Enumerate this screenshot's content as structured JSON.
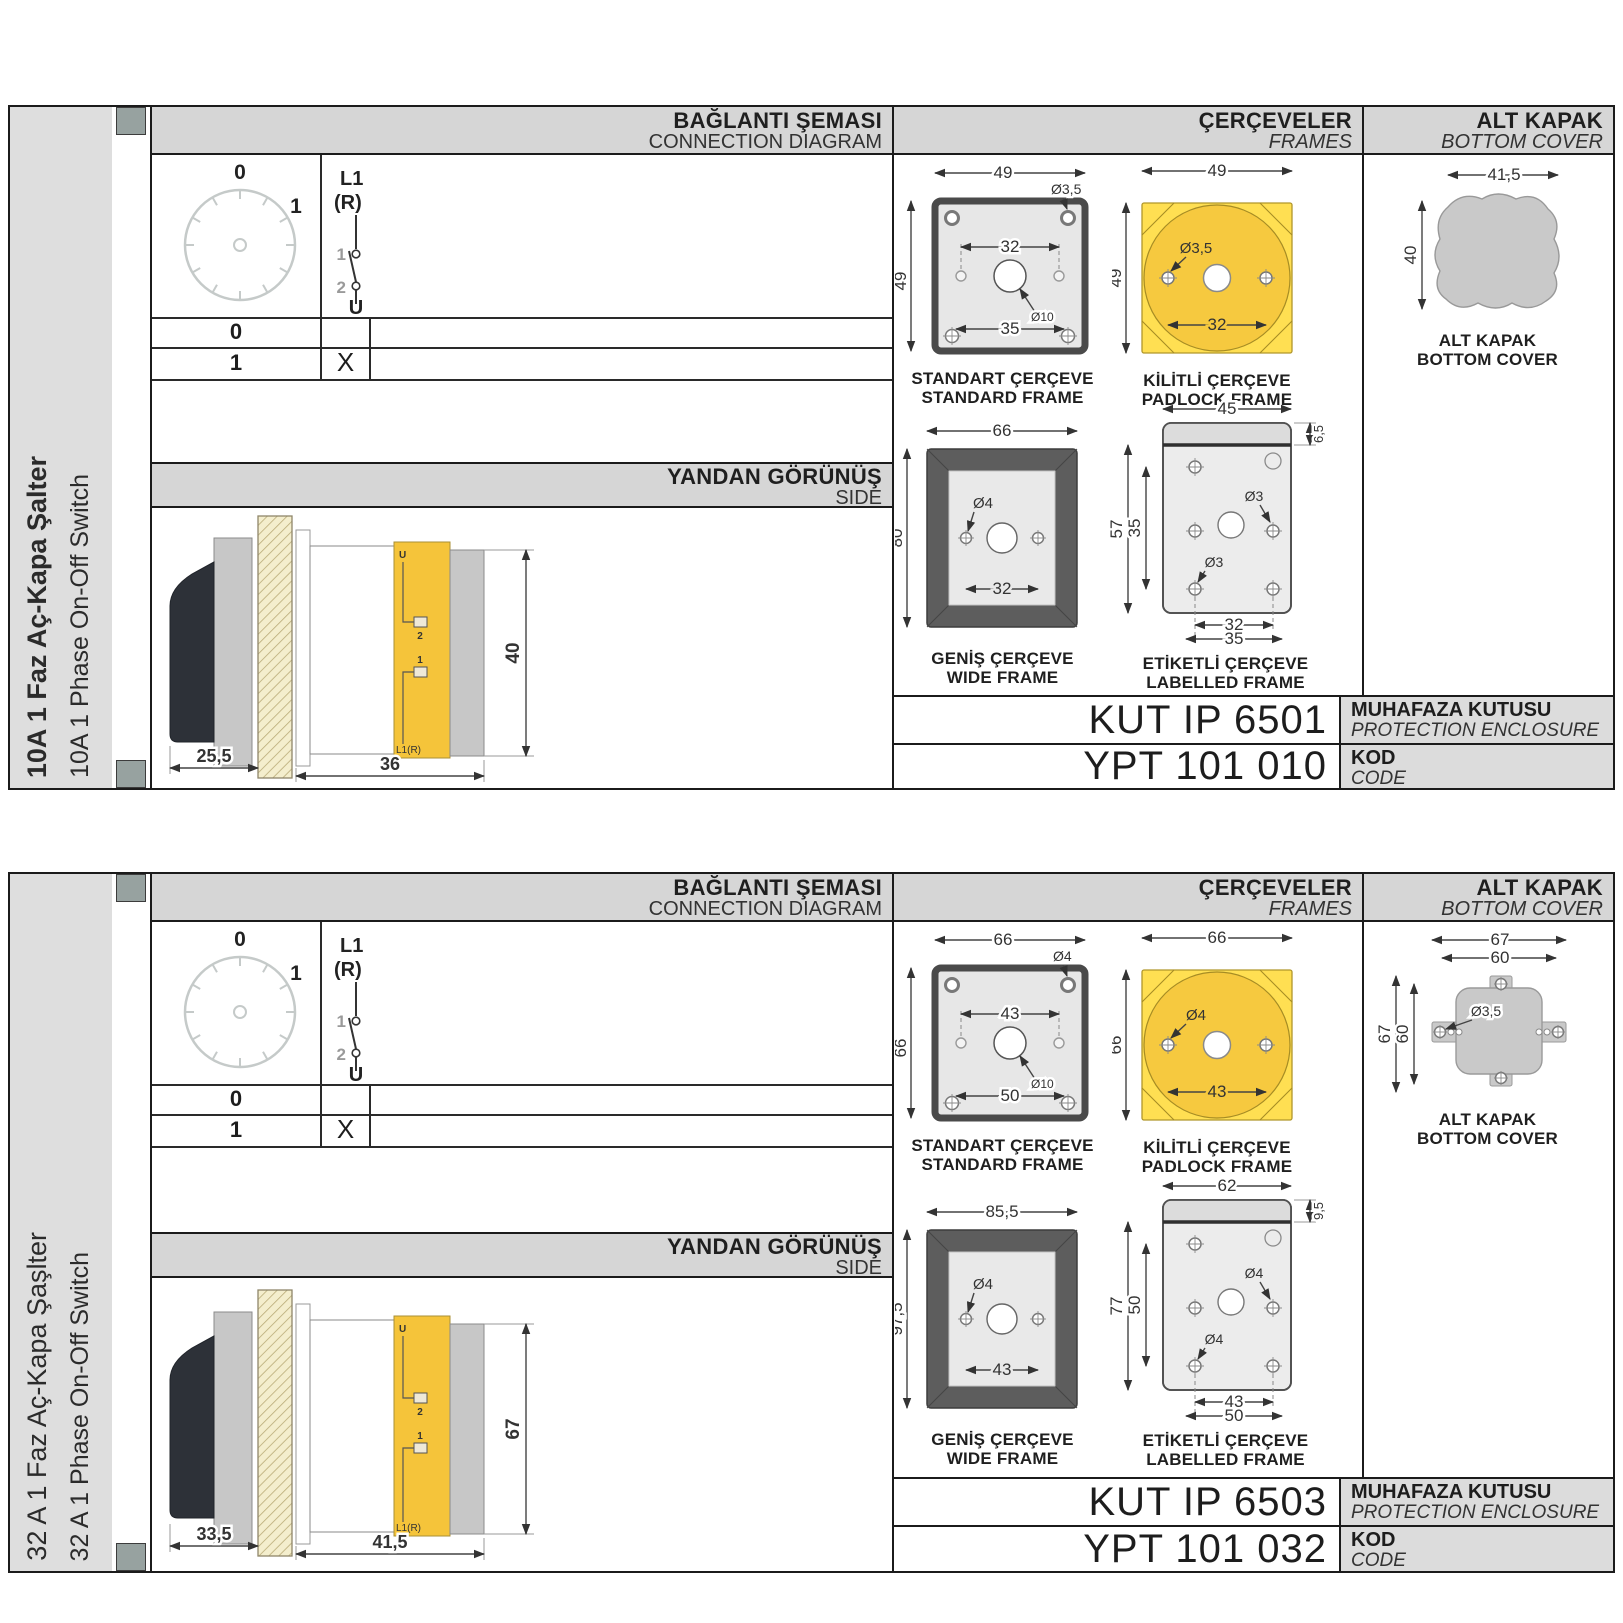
{
  "colors": {
    "accent_yellow": "#ffdf52",
    "circle_yellow": "#f6c93f",
    "band_grey": "#d6d6d6",
    "sidebar_grey": "#dedede",
    "marker_grey": "#97a2a0",
    "cover_grey": "#c9c9c9",
    "wide_frame_dark": "#5d5d5d",
    "body_yellow": "#f5c43a",
    "handle_black": "#2d3138"
  },
  "sections": [
    {
      "sidebar": {
        "title_tr": "10A 1 Faz Aç-Kapa Şalter",
        "title_en": "10A 1 Phase On-Off Switch"
      },
      "headers": {
        "connection_tr": "BAĞLANTI ŞEMASI",
        "connection_en": "CONNECTION DIAGRAM",
        "frames_tr": "ÇERÇEVELER",
        "frames_en": "FRAMES",
        "cover_tr": "ALT KAPAK",
        "cover_en": "BOTTOM COVER",
        "side_tr": "YANDAN GÖRÜNÜŞ",
        "side_en": "SIDE"
      },
      "diagram": {
        "pos0": "0",
        "pos1": "1",
        "phase": "L1",
        "phase_alt": "(R)",
        "c1": "1",
        "c2": "2",
        "terminal": "U",
        "table": {
          "rows": [
            {
              "pos": "0",
              "mark": ""
            },
            {
              "pos": "1",
              "mark": "X"
            }
          ]
        }
      },
      "side_view": {
        "depth_handle": "25,5",
        "depth_body": "36",
        "height": "40",
        "term_top": "U",
        "term_2": "2",
        "term_1": "1",
        "term_bottom": "L1(R)"
      },
      "frames": {
        "standard": {
          "name_tr": "STANDART ÇERÇEVE",
          "name_en": "STANDARD FRAME",
          "width": "49",
          "height": "49",
          "hole": "Ø3,5",
          "center_hole": "Ø10",
          "pitch": "32",
          "pitch2": "35"
        },
        "padlock": {
          "name_tr": "KİLİTLİ ÇERÇEVE",
          "name_en": "PADLOCK FRAME",
          "width": "49",
          "height": "49",
          "hole": "Ø3,5",
          "pitch": "32"
        },
        "wide": {
          "name_tr": "GENİŞ ÇERÇEVE",
          "name_en": "WIDE FRAME",
          "width": "66",
          "height": "80",
          "hole": "Ø4",
          "pitch": "32"
        },
        "labelled": {
          "name_tr": "ETİKETLİ ÇERÇEVE",
          "name_en": "LABELLED FRAME",
          "width": "45",
          "band": "6,5",
          "height": "57",
          "inner": "35",
          "hole_mid": "Ø3",
          "hole_bottom": "Ø3",
          "pitch": "32",
          "pitch2": "35"
        }
      },
      "cover": {
        "caption_tr": "ALT KAPAK",
        "caption_en": "BOTTOM COVER",
        "width": "41,5",
        "height": "40"
      },
      "codes": {
        "enclosure_code": "KUT IP 6501",
        "enclosure_tr": "MUHAFAZA KUTUSU",
        "enclosure_en": "PROTECTION ENCLOSURE",
        "product_code": "YPT 101 010",
        "code_tr": "KOD",
        "code_en": "CODE"
      }
    },
    {
      "sidebar": {
        "title_tr": "32 A 1 Faz Aç-Kapa Şaşlter",
        "title_en": "32 A 1 Phase On-Off Switch"
      },
      "headers": {
        "connection_tr": "BAĞLANTI ŞEMASI",
        "connection_en": "CONNECTION DIAGRAM",
        "frames_tr": "ÇERÇEVELER",
        "frames_en": "FRAMES",
        "cover_tr": "ALT KAPAK",
        "cover_en": "BOTTOM COVER",
        "side_tr": "YANDAN GÖRÜNÜŞ",
        "side_en": "SIDE"
      },
      "diagram": {
        "pos0": "0",
        "pos1": "1",
        "phase": "L1",
        "phase_alt": "(R)",
        "c1": "1",
        "c2": "2",
        "terminal": "U",
        "table": {
          "rows": [
            {
              "pos": "0",
              "mark": ""
            },
            {
              "pos": "1",
              "mark": "X"
            }
          ]
        }
      },
      "side_view": {
        "depth_handle": "33,5",
        "depth_body": "41,5",
        "height": "67",
        "term_top": "U",
        "term_2": "2",
        "term_1": "1",
        "term_bottom": "L1(R)"
      },
      "frames": {
        "standard": {
          "name_tr": "STANDART ÇERÇEVE",
          "name_en": "STANDARD FRAME",
          "width": "66",
          "height": "66",
          "hole": "Ø4",
          "center_hole": "Ø10",
          "pitch": "43",
          "pitch2": "50"
        },
        "padlock": {
          "name_tr": "KİLİTLİ ÇERÇEVE",
          "name_en": "PADLOCK FRAME",
          "width": "66",
          "height": "66",
          "hole": "Ø4",
          "pitch": "43"
        },
        "wide": {
          "name_tr": "GENİŞ ÇERÇEVE",
          "name_en": "WIDE FRAME",
          "width": "85,5",
          "height": "97,5",
          "hole": "Ø4",
          "pitch": "43"
        },
        "labelled": {
          "name_tr": "ETİKETLİ ÇERÇEVE",
          "name_en": "LABELLED FRAME",
          "width": "62",
          "band": "9,5",
          "height": "77",
          "inner": "50",
          "hole_mid": "Ø4",
          "hole_bottom": "Ø4",
          "pitch": "43",
          "pitch2": "50"
        }
      },
      "cover": {
        "caption_tr": "ALT KAPAK",
        "caption_en": "BOTTOM COVER",
        "w_outer": "67",
        "w_inner": "60",
        "h_outer": "67",
        "h_inner": "60",
        "hole": "Ø3,5"
      },
      "codes": {
        "enclosure_code": "KUT IP 6503",
        "enclosure_tr": "MUHAFAZA KUTUSU",
        "enclosure_en": "PROTECTION ENCLOSURE",
        "product_code": "YPT 101 032",
        "code_tr": "KOD",
        "code_en": "CODE"
      }
    }
  ]
}
